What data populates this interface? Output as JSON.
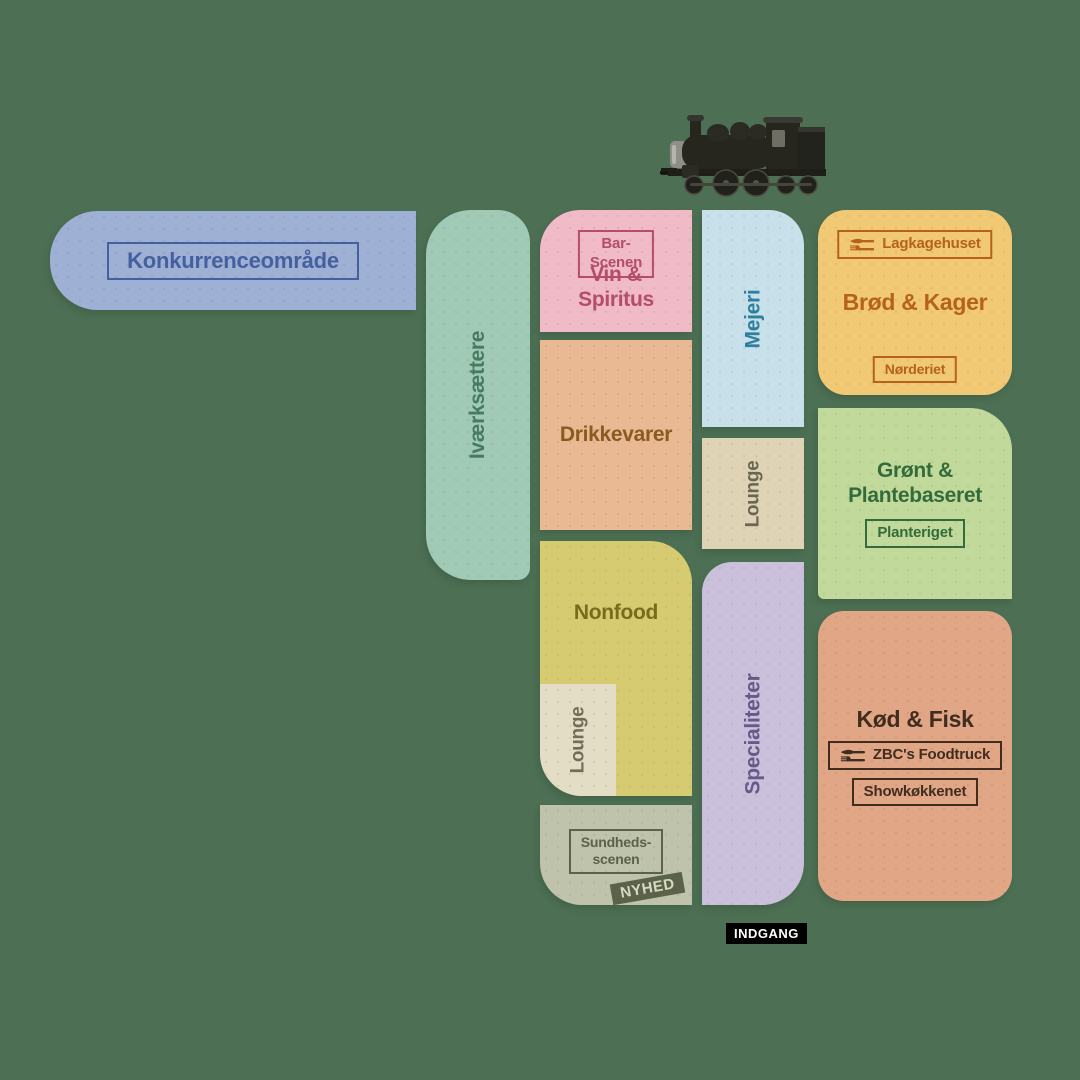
{
  "background": "#4d7054",
  "icons": {
    "train": "steam-locomotive",
    "badge_cutlery": "fork-and-knife"
  },
  "entrance": {
    "label": "INDGANG",
    "fill": "#000000",
    "text": "#ffffff"
  },
  "zones": {
    "konkurrence": {
      "label": "Konkurrenceområde",
      "fill": "#9fb0d5",
      "text": "#44609f"
    },
    "ivaerksaettere": {
      "label": "Iværksættere",
      "fill": "#a0cab5",
      "text": "#497a61"
    },
    "vin": {
      "label": "Vin &\nSpiritus",
      "badge": "Bar-Scenen",
      "fill": "#f0bbc7",
      "text": "#b34d68"
    },
    "mejeri": {
      "label": "Mejeri",
      "fill": "#c7e0ea",
      "text": "#2f7f9e"
    },
    "lounge_mejeri": {
      "label": "Lounge",
      "fill": "#ded3b5",
      "text": "#6c6650"
    },
    "broed": {
      "label": "Brød & Kager",
      "badge_top": "Lagkagehuset",
      "badge_bottom": "Nørderiet",
      "fill": "#f1c975",
      "text": "#b5621c"
    },
    "drikkevarer": {
      "label": "Drikkevarer",
      "fill": "#e9b994",
      "text": "#8a5a20"
    },
    "groent": {
      "label": "Grønt &\nPlantebaseret",
      "badge": "Planteriget",
      "fill": "#c1da9c",
      "text": "#336b3a"
    },
    "nonfood": {
      "label": "Nonfood",
      "fill": "#d7cb72",
      "text": "#7a6a1e"
    },
    "lounge_nonfood": {
      "label": "Lounge",
      "fill": "#e4ddc6",
      "text": "#716d59"
    },
    "specialiteter": {
      "label": "Specialiteter",
      "fill": "#cbc0db",
      "text": "#675a88"
    },
    "koed": {
      "label": "Kød & Fisk",
      "badge_top": "ZBC's Foodtruck",
      "badge_bottom": "Showkøkkenet",
      "fill": "#e1a685",
      "text": "#402d20"
    },
    "sundhed": {
      "label": "Sundheds-\nscenen",
      "tag": "NYHED",
      "fill": "#bfc3ac",
      "text": "#5a624a",
      "tag_fill": "#5a624a",
      "tag_text": "#d6dabf"
    }
  }
}
